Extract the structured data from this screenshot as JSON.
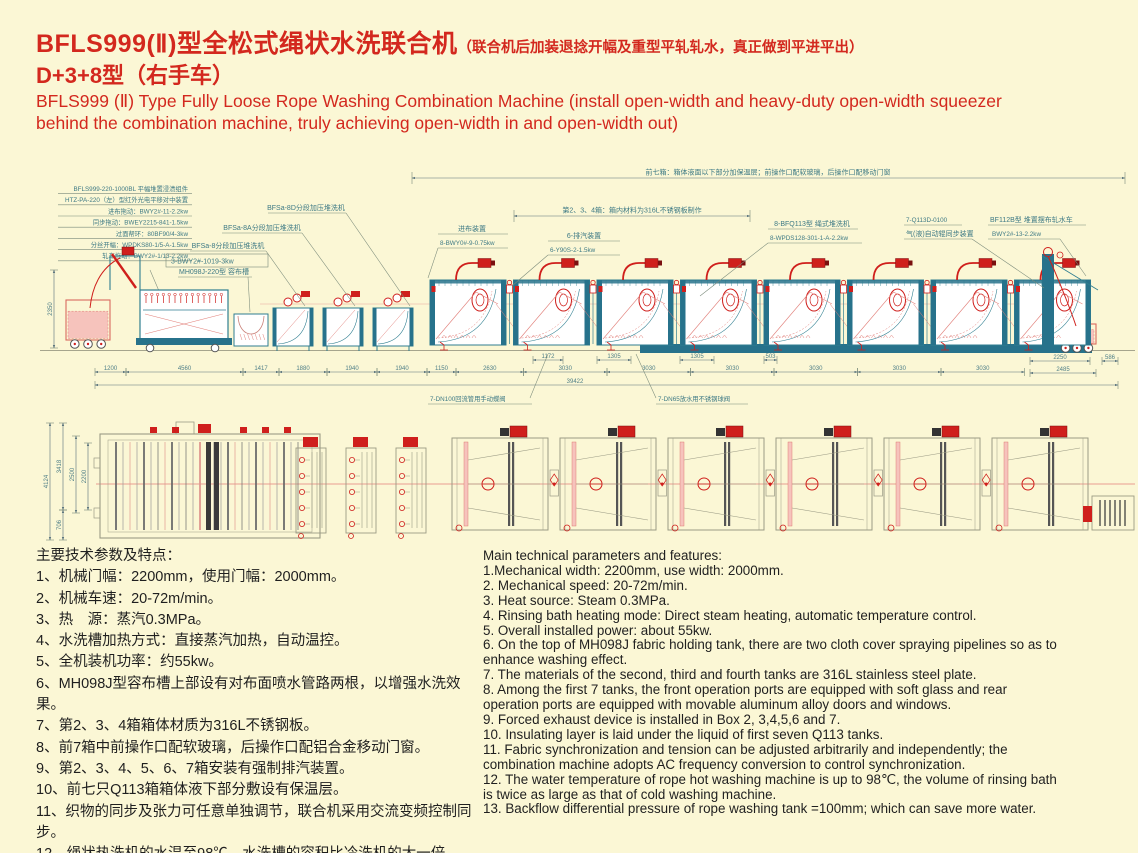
{
  "header": {
    "title_zh": "BFLS999(Ⅱ)型全松式绳状水洗联合机",
    "title_zh_note": "（联合机后加装退捻开幅及重型平轧轧水，真正做到平进平出）",
    "subtitle_zh": "D+3+8型（右手车）",
    "title_en": "BFLS999 (Ⅱ) Type Fully Loose Rope Washing Combination Machine (install open-width and heavy-duty open-width squeezer behind the combination machine, truly achieving open-width in and open-width out)"
  },
  "colors": {
    "background": "#FBF7D5",
    "accent_red": "#D3281E",
    "diagram_teal": "#2F7E90",
    "diagram_teal_dark": "#27728B",
    "diagram_red": "#CF1F1C",
    "diagram_red_light": "#E2807A",
    "pink_fill": "#F6C3BC",
    "pink_stroke": "#D96A60",
    "plan_gray": "#9B9B85",
    "dim_color": "#56707A"
  },
  "diagram": {
    "legend_rows": [
      "BFLS999-220-1000BL 平幅堆置浸渍组件",
      "HTZ-PA-220（左）型红外光电平移对中装置",
      "进布拖动：BWY2#-11-2.2kw",
      "同步拖动：BWEY2215-841-1.5kw",
      "过面帮环：80BF90/4-3kw",
      "分丝开幅：WPDKS80-1/5-A-1.5kw",
      "轧车拖动：BWY2#-1/13-2.2kw"
    ],
    "callout_bfsa8d": "BFSa-8D分段加压堆洗机",
    "callout_bfsa8a": "BFSa-8A分段加压堆洗机",
    "callout_bfsa8": "BFSa-8分段加压堆洗机",
    "callout_motor3": "3-BWY2#-1019-3kw",
    "callout_mh098j": "MH098J-220型 容布槽",
    "note_front7": "前七箱：箱体液面以下部分加保温层；前操作口配软玻璃，后操作口配移动门窗",
    "note_tanks234": "第2、3、4箱：箱内材料为316L不锈钢板制作",
    "callout_jinbu": "进布装置",
    "callout_jinbu_sub": "8-BWY0#-9-0.75kw",
    "callout_paiqi": "6-排汽装置",
    "callout_paiqi_sub": "6-Y90S-2-1.5kw",
    "callout_bfq113": "8-BFQ113型 绳式堆洗机",
    "callout_bfq113_sub": "8-WPDS128-301-1-A-2.2kw",
    "callout_q113d": "7-Q113D-0100",
    "callout_q113d_sub": "气(液)自动辊同步装置",
    "callout_bf112b": "BF112B型 堆置摆布轧水车",
    "callout_bf112b_sub": "BWY2#-13-2.2kw",
    "callout_dn100": "7-DN100回流管用手动蝶阀",
    "callout_dn65": "7-DN65放水用不锈钢球阀",
    "dim_left_elevation": "2350",
    "dims_top_small": [
      "1172",
      "1305",
      "1305",
      "503"
    ],
    "dims_bottom": [
      "1200",
      "4560",
      "1417",
      "1880",
      "1940",
      "1940",
      "1150",
      "2630",
      "3030",
      "3030",
      "3030",
      "3030",
      "3030",
      "3030"
    ],
    "dims_right_stack": [
      "2250",
      "2485"
    ],
    "dim_right_end": "586",
    "dim_total": "39422",
    "plan_dims": [
      "4124",
      "3418",
      "706",
      "2500",
      "2200"
    ]
  },
  "params_zh": {
    "heading": "主要技术参数及特点：",
    "items": [
      "1、机械门幅：2200mm，使用门幅：2000mm。",
      "2、机械车速：20-72m/min。",
      "3、热　源：蒸汽0.3MPa。",
      "4、水洗槽加热方式：直接蒸汽加热，自动温控。",
      "5、全机装机功率：约55kw。",
      "6、MH098J型容布槽上部设有对布面喷水管路两根，以增强水洗效果。",
      "7、第2、3、4箱箱体材质为316L不锈钢板。",
      "8、前7箱中前操作口配软玻璃，后操作口配铝合金移动门窗。",
      "9、第2、3、4、5、6、7箱安装有强制排汽装置。",
      "10、前七只Q113箱箱体液下部分敷设有保温层。",
      "11、织物的同步及张力可任意单独调节，联合机采用交流变频控制同步。",
      "12、绳状热洗机的水温至98℃，水洗槽的容积比冷洗机的大一倍。",
      "13、绳洗箱倒流压差=100mm；更省水。"
    ]
  },
  "params_en": {
    "heading": "Main technical parameters and features:",
    "items": [
      "1.Mechanical width: 2200mm, use width: 2000mm.",
      "2. Mechanical speed: 20-72m/min.",
      "3. Heat source: Steam 0.3MPa.",
      "4. Rinsing bath heating mode: Direct steam heating, automatic temperature control.",
      "5. Overall installed power: about 55kw.",
      "6. On the top of MH098J fabric holding tank, there are two cloth cover spraying pipelines so as to enhance washing effect.",
      "7. The materials of the second, third and fourth tanks are 316L stainless steel plate.",
      "8. Among the first 7 tanks, the front operation ports are equipped with soft glass and rear operation ports are equipped with movable aluminum alloy doors and windows.",
      "9. Forced exhaust device is installed in Box 2, 3,4,5,6 and 7.",
      "10. Insulating layer is laid under the liquid of first seven Q113 tanks.",
      "11. Fabric synchronization and tension can be adjusted arbitrarily and independently; the combination machine adopts AC frequency conversion to control synchronization.",
      "12. The water temperature of rope hot washing machine is up to 98℃, the volume of rinsing bath is twice as large as that of cold washing machine.",
      "13. Backflow differential pressure of rope washing tank =100mm; which can save more water."
    ]
  }
}
